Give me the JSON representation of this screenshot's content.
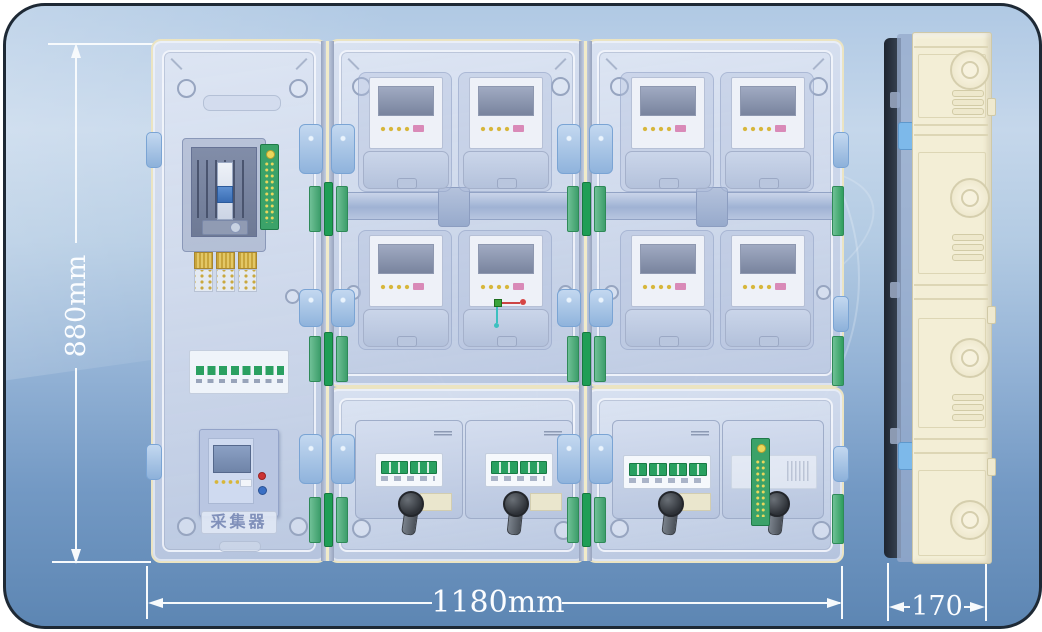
{
  "annotations": {
    "height_label": "880mm",
    "width_label": "1180mm",
    "depth_label": "170"
  },
  "front_view": {
    "collector_label": "采集器",
    "meter_count": 8,
    "breaker_module_count": 4,
    "sections": [
      "service-compartment-left",
      "meter-compartment-middle",
      "meter-compartment-right",
      "breaker-compartment-middle",
      "breaker-compartment-right"
    ]
  },
  "side_view": {
    "knockout_count": 4
  },
  "colors": {
    "background_top": "#b0c9e4",
    "background_bottom": "#5d86b3",
    "frame_border": "#1e2935",
    "door_panel_blue": "#ccd6ea",
    "door_outline_cream": "#ebe4c2",
    "hinge_green": "#2f9e5e",
    "latch_blue": "#9ec3eb",
    "side_box_cream": "#f3eed6",
    "dimension_color": "#ffffff",
    "collector_text_color": "#8090ba",
    "lcd_gray": "#79849e",
    "led_yellow": "#d7b63a",
    "led_pink": "#d98ab8"
  }
}
